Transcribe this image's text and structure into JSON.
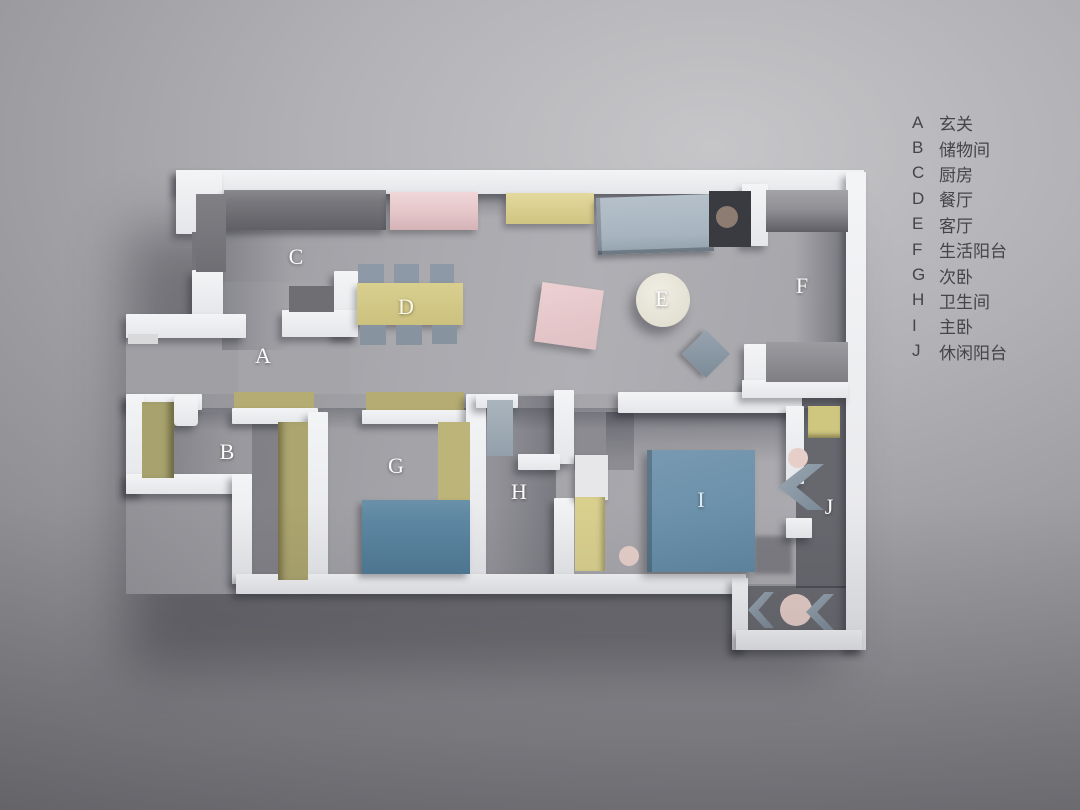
{
  "title": "apartment-floor-plan-render",
  "rooms": [
    {
      "letter": "A",
      "name": "玄关"
    },
    {
      "letter": "B",
      "name": "储物间"
    },
    {
      "letter": "C",
      "name": "厨房"
    },
    {
      "letter": "D",
      "name": "餐厅"
    },
    {
      "letter": "E",
      "name": "客厅"
    },
    {
      "letter": "F",
      "name": "生活阳台"
    },
    {
      "letter": "G",
      "name": "次卧"
    },
    {
      "letter": "H",
      "name": "卫生间"
    },
    {
      "letter": "I",
      "name": "主卧"
    },
    {
      "letter": "J",
      "name": "休闲阳台"
    }
  ],
  "palette": {
    "background": "#9c9ca0",
    "wall": "#eef0f2",
    "floor": "#a5a5aa",
    "bed_blue": "#6e93ac",
    "sofa_blue": "#a9b5c0",
    "wardrobe_yellow": "#d9d08e",
    "shelf_olive": "#a8a26e",
    "cabinet_pink": "#e6c8ca",
    "table_cream": "#e9e7db",
    "legend_text": "#454549",
    "plan_label_text": "#fcfcfd"
  }
}
